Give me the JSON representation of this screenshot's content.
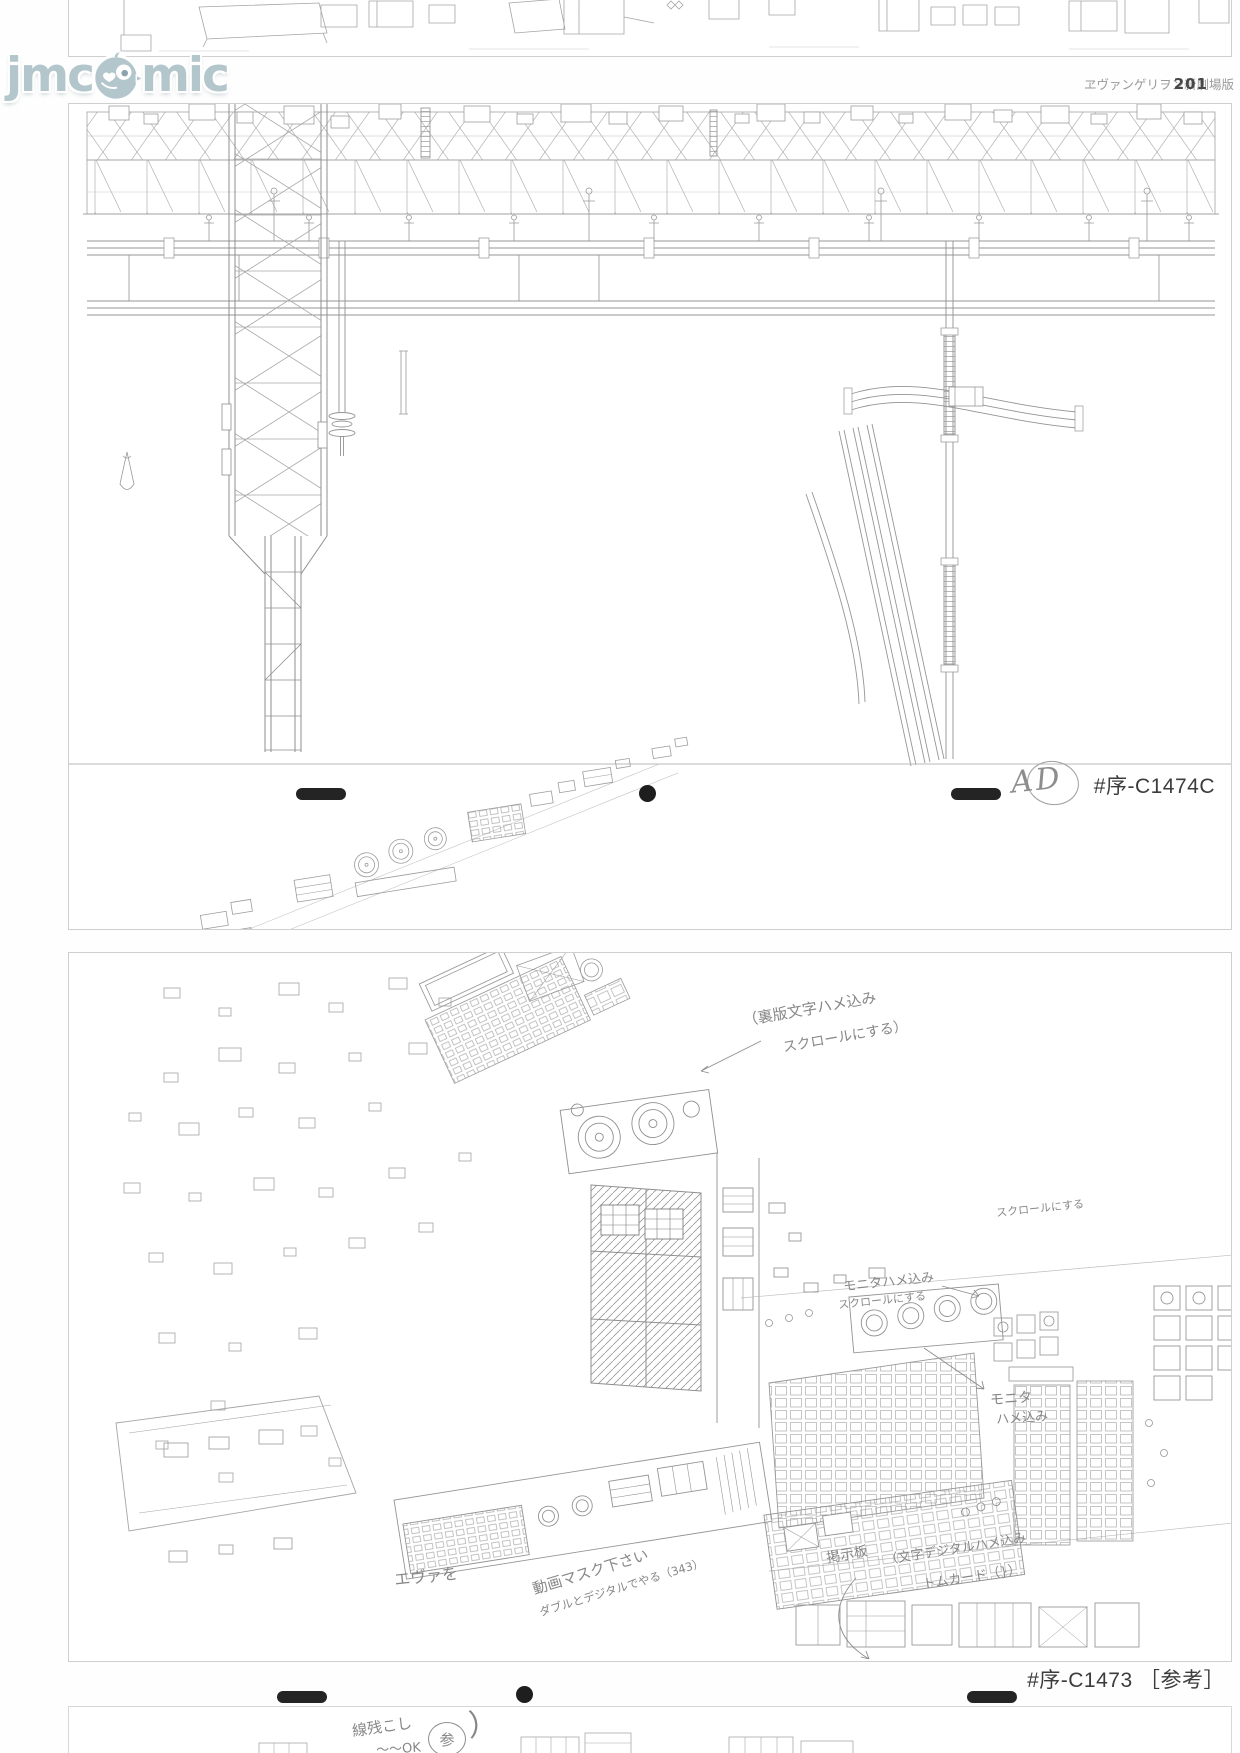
{
  "watermark": {
    "prefix": "jmc",
    "suffix": "mic",
    "mascot_icon": "bird-mascot-icon"
  },
  "header": {
    "series_title": "ヱヴァンゲリヲン新劇場版",
    "page_number": "201"
  },
  "sheet_c1474c": {
    "cut_label": "#序-C1474C",
    "check_initials": "AD"
  },
  "sheet_c1473": {
    "cut_label": "#序-C1473",
    "reference_tag": "［参考］"
  },
  "handwritten_notes": [
    {
      "text": "（裏版文字ハメ込み"
    },
    {
      "text": "スクロールにする）"
    },
    {
      "text": "スクロールにする"
    },
    {
      "text": "モニタハメ込み"
    },
    {
      "text": "スクロールにする"
    },
    {
      "text": "モニタ"
    },
    {
      "text": "ハメ込み"
    },
    {
      "text": "エヴァを"
    },
    {
      "text": "動画マスク下さい"
    },
    {
      "text": "ダブルとデジタルでやる（343）"
    },
    {
      "text": "掲示板"
    },
    {
      "text": "（文字デジタルハメ込み"
    },
    {
      "text": "トムカード（}）"
    },
    {
      "text": "線残こし"
    },
    {
      "text": "〜〜OK"
    },
    {
      "text": "参"
    },
    {
      "text": "）"
    }
  ],
  "icons": {
    "logo_mascot": "bird-mascot-icon",
    "registration_bar": "registration-bar-mark",
    "registration_dot": "registration-dot-mark"
  },
  "colors": {
    "logo_teal": "#b3c6cc",
    "pencil_gray": "#9b9b9b",
    "mark_black": "#222222",
    "frame_gray": "#cfcfcf"
  }
}
